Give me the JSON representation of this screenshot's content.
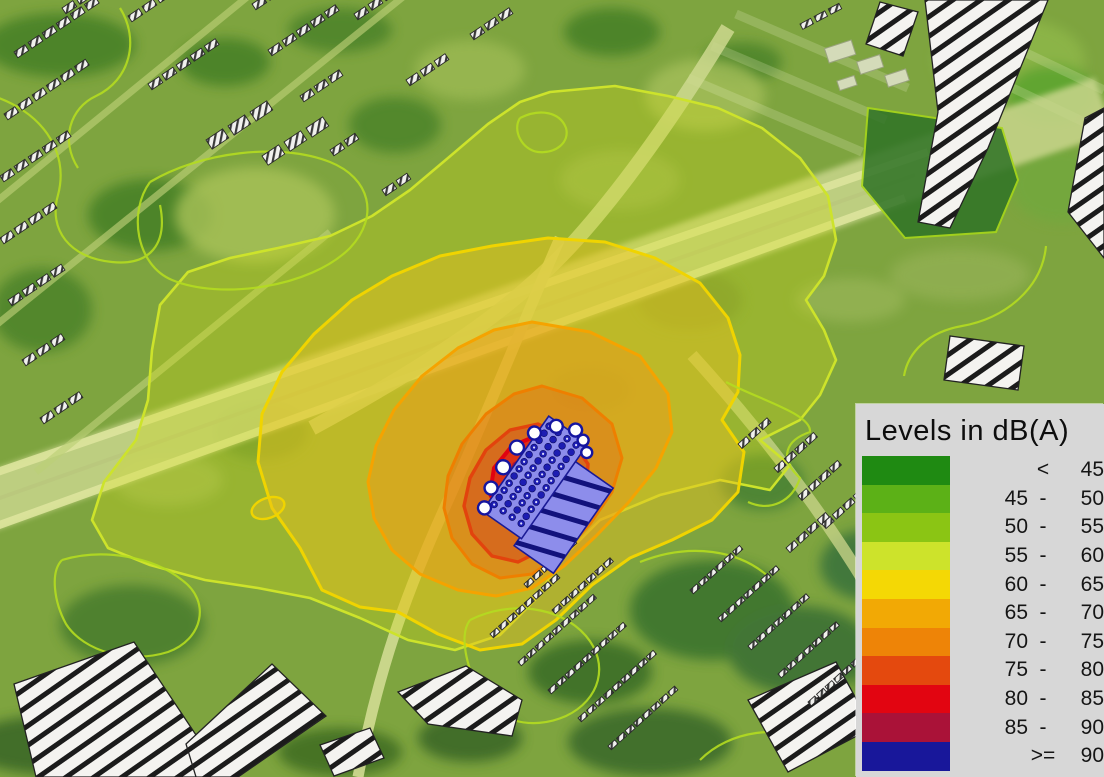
{
  "legend": {
    "title": "Levels in dB(A)",
    "items": [
      {
        "low": "",
        "sep": "<",
        "high": "45",
        "color": "#1f8a12",
        "name": "lt-45"
      },
      {
        "low": "45",
        "sep": "-",
        "high": "50",
        "color": "#5cb117",
        "name": "45-50"
      },
      {
        "low": "50",
        "sep": "-",
        "high": "55",
        "color": "#8bc514",
        "name": "50-55"
      },
      {
        "low": "55",
        "sep": "-",
        "high": "60",
        "color": "#cde32b",
        "name": "55-60"
      },
      {
        "low": "60",
        "sep": "-",
        "high": "65",
        "color": "#f4d805",
        "name": "60-65"
      },
      {
        "low": "65",
        "sep": "-",
        "high": "70",
        "color": "#f2a905",
        "name": "65-70"
      },
      {
        "low": "70",
        "sep": "-",
        "high": "75",
        "color": "#ee8407",
        "name": "70-75"
      },
      {
        "low": "75",
        "sep": "-",
        "high": "80",
        "color": "#e4490e",
        "name": "75-80"
      },
      {
        "low": "80",
        "sep": "-",
        "high": "85",
        "color": "#e20511",
        "name": "80-85"
      },
      {
        "low": "85",
        "sep": "-",
        "high": "90",
        "color": "#aa1238",
        "name": "85-90"
      },
      {
        "low": "",
        "sep": ">=",
        "high": "90",
        "color": "#18179a",
        "name": "ge-90"
      }
    ]
  }
}
